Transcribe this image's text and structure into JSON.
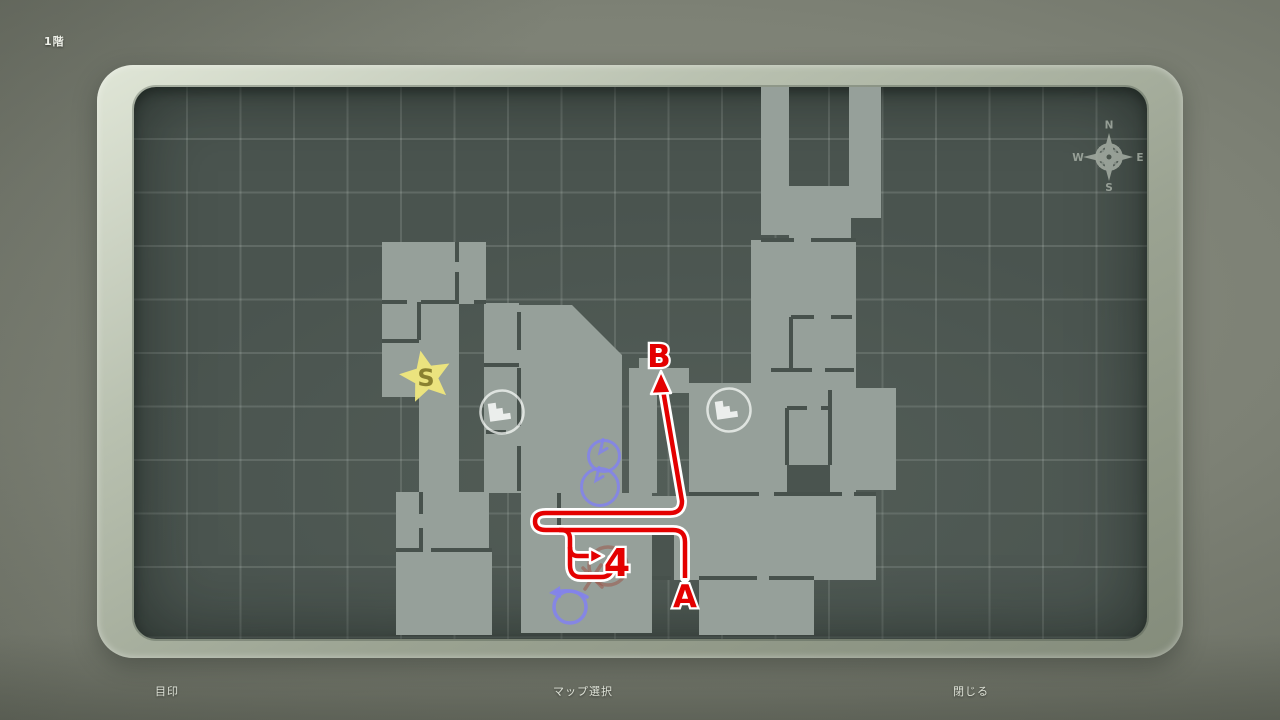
{
  "floor_label": "1階",
  "menu": {
    "marker": "目印",
    "map_select": "マップ選択",
    "close": "閉じる"
  },
  "compass": {
    "n": "N",
    "e": "E",
    "s": "S",
    "w": "W",
    "cx": 1110,
    "cy": 157,
    "color": "#aeb6ac"
  },
  "map": {
    "bg": "#4a544f",
    "room_fill": "#96a09a",
    "wall_color": "#47514c",
    "rooms": [
      [
        762,
        85,
        28,
        150
      ],
      [
        850,
        85,
        32,
        133
      ],
      [
        790,
        186,
        62,
        56
      ],
      [
        752,
        240,
        105,
        256
      ],
      [
        855,
        388,
        42,
        102
      ],
      [
        690,
        383,
        62,
        112
      ],
      [
        653,
        496,
        224,
        84
      ],
      [
        700,
        580,
        115,
        55
      ],
      [
        383,
        242,
        104,
        62
      ],
      [
        383,
        304,
        77,
        93
      ],
      [
        420,
        397,
        40,
        96
      ],
      [
        397,
        492,
        93,
        60
      ],
      [
        397,
        552,
        96,
        83
      ],
      [
        485,
        303,
        35,
        190
      ],
      [
        630,
        368,
        60,
        25
      ],
      [
        640,
        358,
        18,
        12
      ],
      [
        630,
        393,
        28,
        100
      ],
      [
        522,
        493,
        38,
        140
      ],
      [
        560,
        493,
        93,
        140
      ]
    ],
    "poly_rooms": [
      [
        [
          520,
          305
        ],
        [
          573,
          305
        ],
        [
          623,
          355
        ],
        [
          623,
          493
        ],
        [
          520,
          493
        ]
      ]
    ],
    "notches": [
      [
        788,
        465,
        43,
        28
      ],
      [
        653,
        528,
        22,
        52
      ]
    ],
    "walls": "M383,302 h25 M422,302 h38 M475,302 h12 M420,302 v38 M383,341 h37 M458,242 v20 M458,272 v30 M485,365 h35 M487,432 h20 M520,312 v38 M520,368 v58 M520,446 v45 M762,240 h33 M812,240 h45 M792,317 v53 M792,317 h23 M832,317 h21 M772,370 h41 M826,370 h29 M788,408 v57 M788,408 h20 M822,408 h9 M831,390 v75 M690,494 h70 M775,494 h68 M855,494 h22 M560,530 h18 M590,530 h63 M397,550 h23 M432,550 h61 M422,492 v22 M422,528 v24 M560,493 v35 M653,578 h19 M700,578 h58 M770,578 h45",
    "route": {
      "color": "#e40000",
      "outline": "#ffffff",
      "paths": [
        "M686,578 V542 Q686,530 674,530 H547 Q536,530 536,521.5 Q536,513 547,513 H671 Q683,513 683,501 L664,390",
        "M560,530 H562 Q571,530 571,539 V565 Q571,577 582,577 H602 Q613,577 613,566 V559",
        "M571,547 Q571,556 579,556 H592"
      ],
      "arrowheads": [
        [
          662,
          371,
          652,
          394,
          672,
          393
        ],
        [
          605,
          556,
          591,
          548.5,
          591,
          563.5
        ]
      ],
      "labels": [
        {
          "text": "A",
          "x": 686,
          "y": 607,
          "size": 31
        },
        {
          "text": "B",
          "x": 660,
          "y": 367,
          "size": 31
        },
        {
          "text": "4",
          "x": 618,
          "y": 576,
          "size": 38
        }
      ]
    },
    "icons": {
      "star": {
        "x": 427,
        "y": 377,
        "label": "S",
        "fill": "#efe77c",
        "text_color": "#8a8130"
      },
      "stairs": [
        [
          503,
          412
        ],
        [
          730,
          410
        ]
      ],
      "stairs_color": "#f5f8f4",
      "pins": [
        {
          "cx": 605,
          "cy": 456,
          "r": 15.5
        },
        {
          "cx": 601,
          "cy": 487,
          "r": 18.5
        }
      ],
      "rotate": {
        "cx": 571,
        "cy": 607,
        "r": 16
      },
      "scribble": {
        "cx": 609,
        "cy": 566,
        "r": 19
      },
      "blue": "#8383ea",
      "scribble_color": "#9c4f42"
    }
  }
}
